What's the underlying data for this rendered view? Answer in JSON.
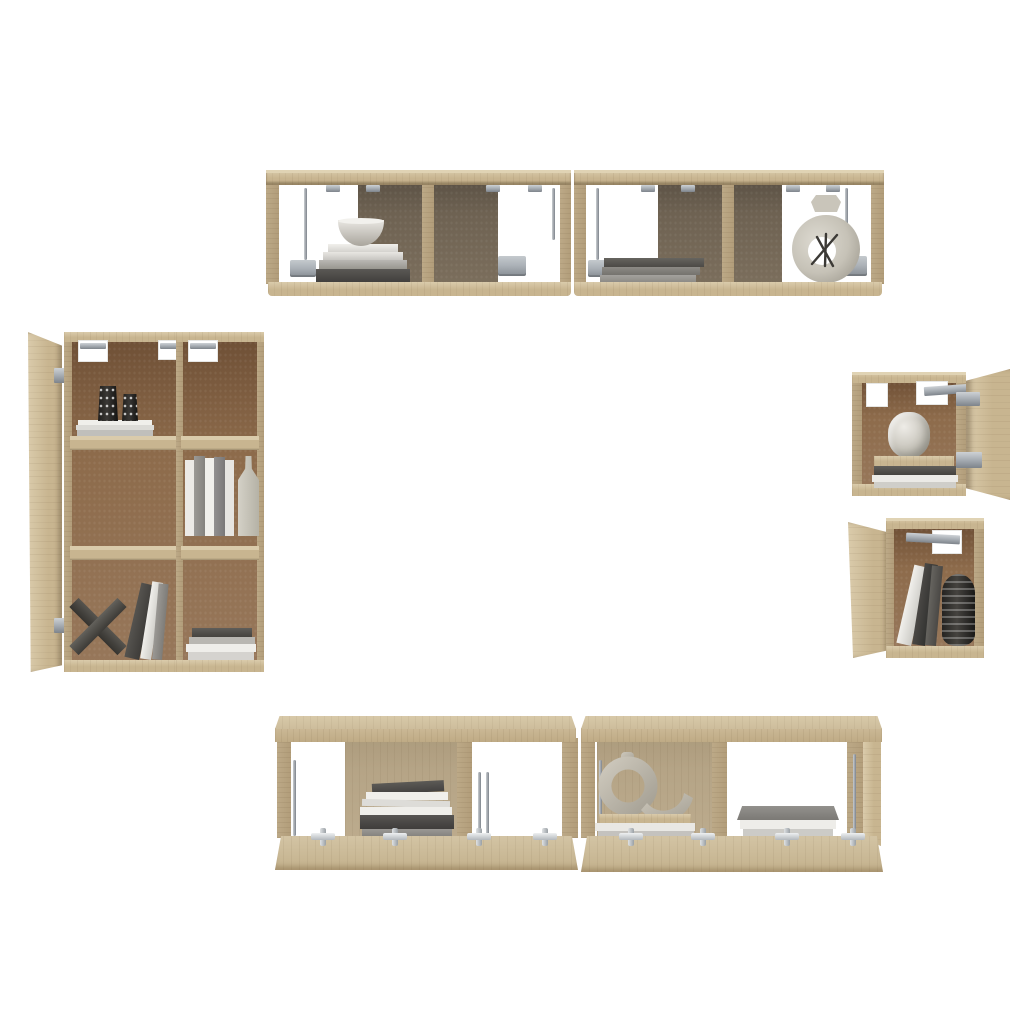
{
  "scene": {
    "type": "product-photo",
    "description": "Wall-mounted TV cabinet furniture set in sonoma oak, shown open with decor, on a plain white studio background",
    "background": "#ffffff",
    "colors": {
      "background": "#ffffff",
      "oak": "#c8b590",
      "oak_light": "#dacbab",
      "oak_top": "#d2c3a3",
      "oak_mid": "#b29d7a",
      "oak_shadow": "#8a7b63",
      "back_dark": "#6e6252",
      "back_brown": "#8d6b4b",
      "back_brown_dark": "#6f5036",
      "back_light_wood": "#b2a183",
      "metal": "#aab0b6",
      "metal_dark": "#7e848b",
      "book_white": "#efeeea",
      "book_gray": "#8e8e8c",
      "book_dark": "#4e4e4c",
      "vase_light": "#c9c5ba",
      "vase_dark": "#35332f"
    },
    "units": [
      {
        "id": "top-wall-shelf",
        "kind": "pair of horizontal wall cabinets with open fronts",
        "position": "top center",
        "hardware": [
          "lid stay rods",
          "wall mounting brackets",
          "hinges"
        ],
        "decor": [
          "stack of books with gray bowl on top",
          "flat stack of dark books",
          "donut-shaped vase with dark twigs"
        ]
      },
      {
        "id": "tall-cabinet-left",
        "kind": "tall narrow wall cabinet with door swung open left",
        "position": "middle left",
        "compartments": 3,
        "decor": [
          "two dark speckled vases on white board stack",
          "empty middle shelf",
          "dark X bookend with leaning books"
        ]
      },
      {
        "id": "tall-cabinet-right",
        "kind": "tall narrow open wall cabinet",
        "position": "middle left",
        "compartments": 3,
        "decor": [
          "empty top shelf",
          "upright white and gray books with bottle vase",
          "flat stack of books"
        ]
      },
      {
        "id": "small-cabinet-top",
        "kind": "small square wall cabinet with door swung open right",
        "position": "middle right",
        "decor": [
          "faceted sphere vase on board and book stack"
        ]
      },
      {
        "id": "small-cabinet-bottom",
        "kind": "small square wall cabinet with door swung open left",
        "position": "middle right",
        "decor": [
          "leaning books",
          "dark ribbed vase"
        ]
      },
      {
        "id": "bottom-tv-bench",
        "kind": "pair of horizontal TV cabinets with drop-down doors folded open",
        "position": "bottom center",
        "hardware": [
          "fold-down door hinges",
          "lid stay rods"
        ],
        "decor": [
          "loose stack of books",
          "ring-and-crescent sculpture on book stack",
          "flat wide stack of books"
        ]
      }
    ]
  }
}
